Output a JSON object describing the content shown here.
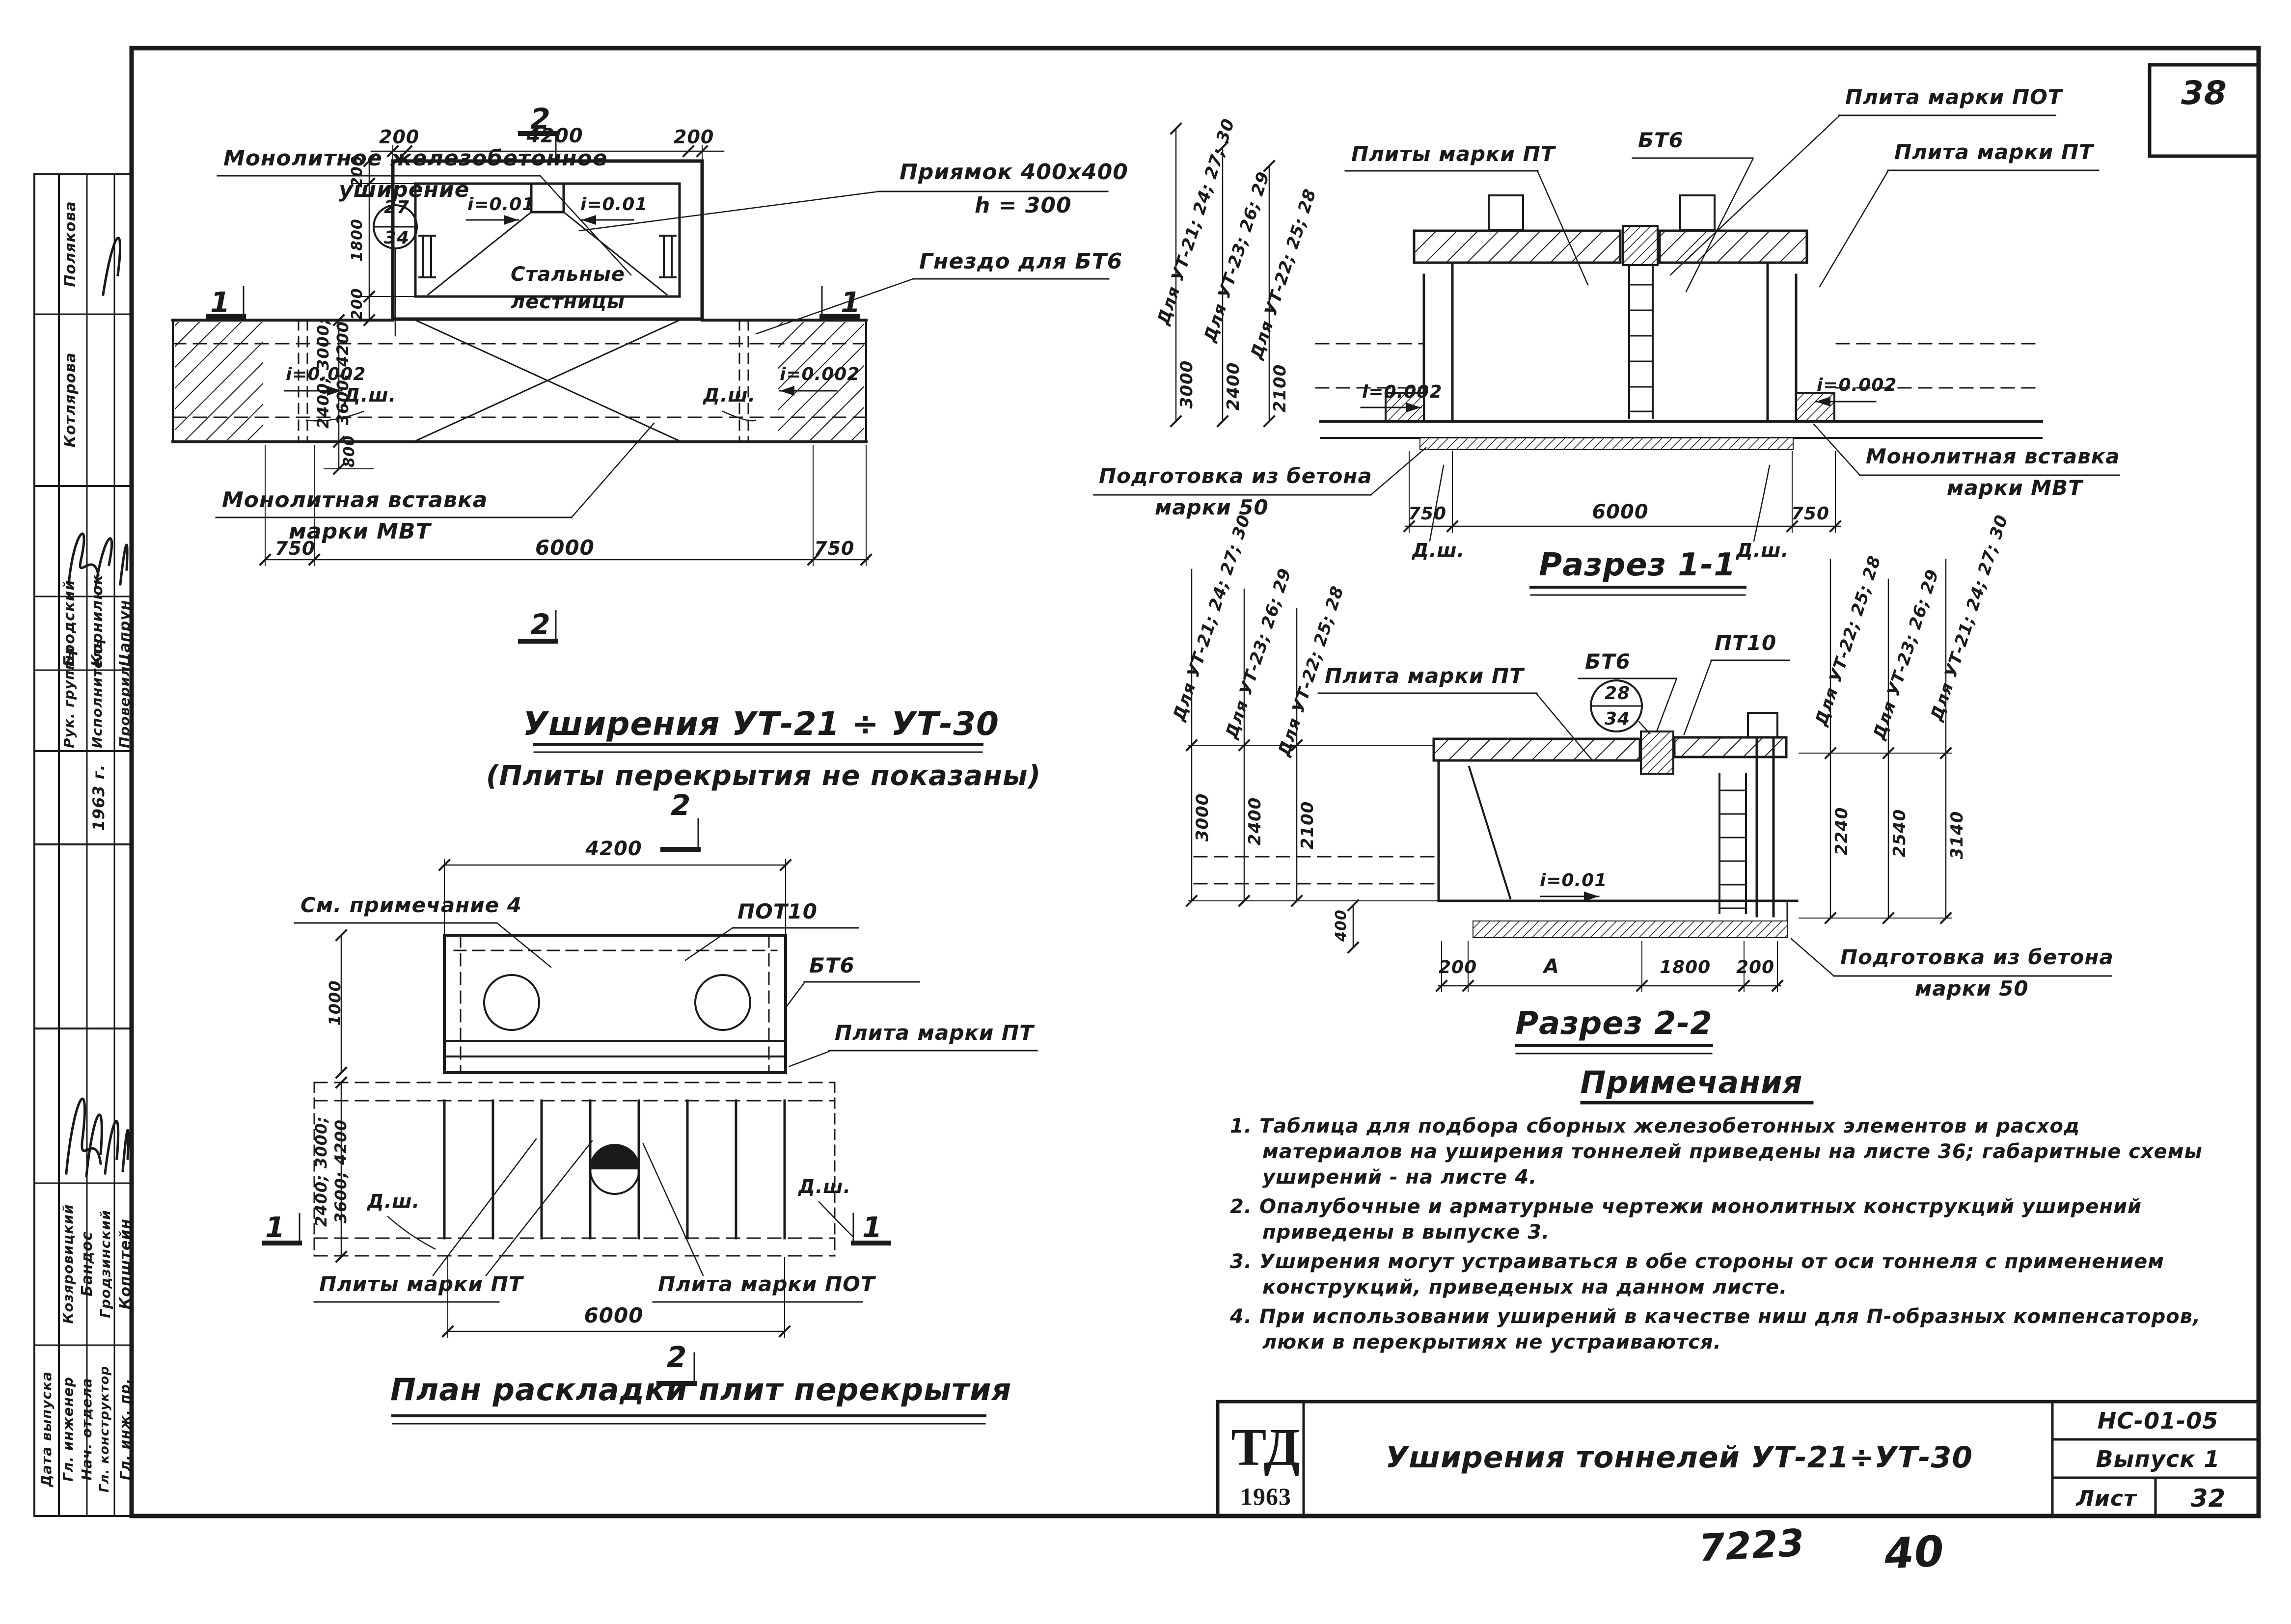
{
  "page": {
    "number": "38",
    "footer_code": "7223",
    "footer_code2": "40"
  },
  "common": {
    "dsh": "Д.ш.",
    "slope_002": "i=0.002",
    "slope_01": "i=0.01",
    "d200": "200",
    "d750": "750",
    "d6000": "6000",
    "d4200": "4200",
    "d1800": "1800",
    "d1000": "1000",
    "d800": "800",
    "d400": "400",
    "d3000": "3000",
    "d2400": "2400",
    "d2100": "2100",
    "range1": "2400; 3000;",
    "range2": "3600; 4200",
    "plate_pt": "Плита марки ПТ",
    "plates_pt": "Плиты марки ПТ",
    "plate_pot": "Плита марки ПОТ",
    "bt6": "БТ6",
    "insert1": "Монолитная вставка",
    "insert2": "марки МВТ",
    "prep1": "Подготовка из бетона",
    "prep2": "марки 50",
    "ut21": "Для УТ-21; 24; 27; 30",
    "ut23": "Для УТ-23; 26; 29",
    "ut22": "Для УТ-22; 25; 28",
    "sec1": "1",
    "sec2": "2",
    "m34": "34"
  },
  "sidebar": {
    "names_top": [
      "Полякова",
      "Котлярова"
    ],
    "group1_names": [
      "Бродский",
      "Корнилюк",
      "Цапрун"
    ],
    "group1_roles": [
      "Рук. группы",
      "Исполнитель",
      "Проверил"
    ],
    "year": "1963 г.",
    "group2_names": [
      "Козяровицкий",
      "Бандос",
      "Гродзинский",
      "Копштейн"
    ],
    "group2_roles": [
      "Гл. инженер",
      "Нач. отдела",
      "Гл. конструктор",
      "Гл. инж. пр."
    ],
    "date_label": "Дата выпуска"
  },
  "d1": {
    "widening1": "Монолитное железобетонное",
    "widening2": "уширение",
    "pit1": "Приямок 400x400",
    "pit2": "h = 300",
    "socket": "Гнездо для БТ6",
    "ladders1": "Стальные",
    "ladders2": "лестницы",
    "m27": "27",
    "title": "Уширения УТ-21 ÷ УТ-30",
    "subtitle": "(Плиты перекрытия не показаны)"
  },
  "d2": {
    "note_ref": "См. примечание 4",
    "pot10": "ПОТ10",
    "title": "План раскладки плит перекрытия"
  },
  "d3": {
    "title": "Разрез 1-1"
  },
  "d4": {
    "pt10": "ПТ10",
    "m28": "28",
    "dim_a": "А",
    "dims_right": [
      "2240",
      "2540",
      "3140"
    ],
    "title": "Разрез 2-2"
  },
  "notes": {
    "title": "Примечания",
    "items": [
      "1. Таблица для подбора сборных железобетонных элементов и расход материалов на уширения тоннелей приведены на листе 36; габаритные схемы уширений - на листе 4.",
      "2. Опалубочные и арматурные чертежи монолитных конструкций уширений приведены в выпуске 3.",
      "3. Уширения могут устраиваться в обе стороны от оси тоннеля с применением конструкций, приведеных на данном листе.",
      "4. При использовании уширений в качестве ниш для П-образных компенсаторов, люки в перекрытиях не устраиваются."
    ]
  },
  "titleblock": {
    "logo1": "ТД",
    "logo2": "1963",
    "title": "Уширения тоннелей УТ-21÷УТ-30",
    "code": "НС-01-05",
    "issue": "Выпуск 1",
    "sheet_label": "Лист",
    "sheet_number": "32"
  }
}
